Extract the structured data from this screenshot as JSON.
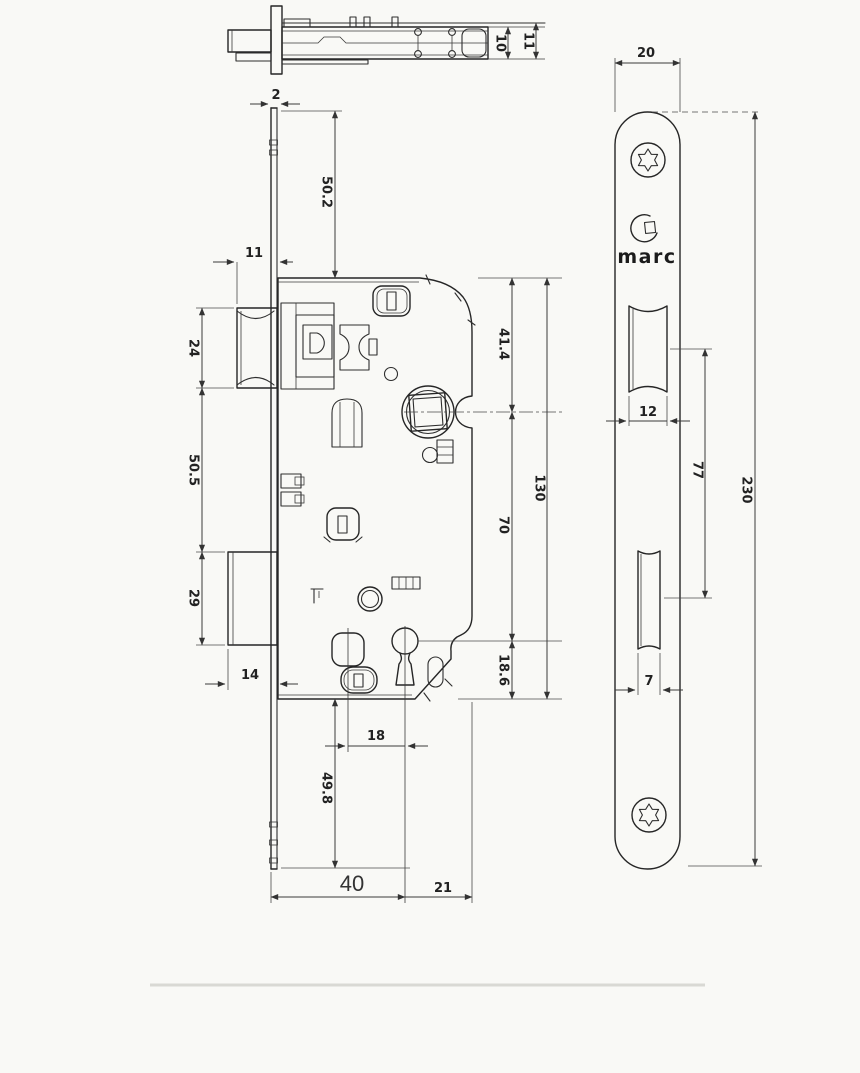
{
  "brand": {
    "name": "marc"
  },
  "dims": {
    "top_view": {
      "plate_thickness": "2",
      "case_depth": "10",
      "total_depth": "11"
    },
    "body": {
      "latch_projection": "11",
      "latch_height": "24",
      "latch_to_deadbolt": "50.5",
      "deadbolt_height": "29",
      "deadbolt_projection": "14",
      "plate_top_to_body": "50.2",
      "body_top_to_spindle": "41.4",
      "spindle_to_keyhole": "70",
      "keyhole_to_bottom": "18.6",
      "body_height": "130",
      "post_to_keyhole": "18",
      "body_bottom_to_plate": "49.8",
      "backset": "40",
      "keyhole_to_back_edge": "21"
    },
    "faceplate": {
      "width": "20",
      "length": "230",
      "latch_cutout": "12",
      "cutout_spacing": "77",
      "deadbolt_cutout": "7"
    }
  }
}
